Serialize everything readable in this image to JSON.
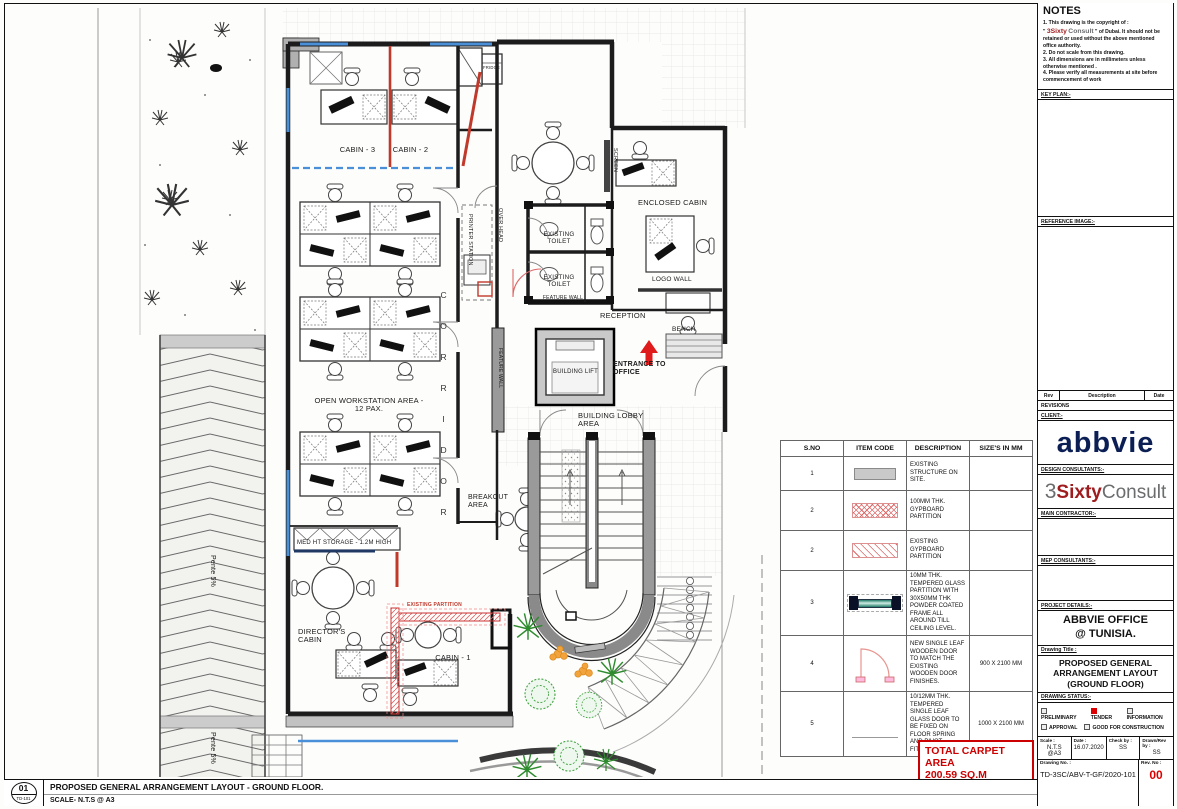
{
  "sheet": {
    "footer": {
      "number": "01",
      "code": "TD-101",
      "title": "PROPOSED GENERAL ARRANGEMENT LAYOUT - GROUND FLOOR.",
      "scale": "SCALE- N.T.S @ A3"
    },
    "carpet": {
      "line1": "TOTAL CARPET AREA",
      "line2": "200.59 SQ.M"
    }
  },
  "plan": {
    "labels": {
      "fridge": "FRIDGE",
      "cabin3": "CABIN - 3",
      "cabin2": "CABIN - 2",
      "cabin1": "CABIN - 1",
      "screen": "SCREEN",
      "over_head": "OVER HEAD",
      "printer_station": "PRINTER STATION",
      "toilet": "EXISTING TOILET",
      "feature_wall": "FEATURE WALL",
      "enclosed_cabin": "ENCLOSED CABIN",
      "logo_wall": "LOGO WALL",
      "reception": "RECEPTION",
      "bench": "BENCH",
      "building_lift": "BUILDING LIFT",
      "entrance": "ENTRANCE TO OFFICE",
      "lobby": "BUILDING LOBBY AREA",
      "corridor": "CORRIDOR",
      "open_ws": "OPEN WORKSTATION AREA - 12 PAX.",
      "breakout": "BREAKOUT AREA",
      "storage": "MED HT STORAGE - 1.2M HIGH",
      "directors": "DIRECTOR'S CABIN",
      "existing_partition": "EXISTING PARTITION",
      "pente": "Pente 5%"
    }
  },
  "legend": {
    "headers": [
      "S.NO",
      "ITEM CODE",
      "DESCRIPTION",
      "SIZE'S IN MM"
    ],
    "rows": [
      {
        "sno": "1",
        "symbol": "existing-structure-swatch",
        "desc": "EXISTING STRUCTURE ON SITE.",
        "size": ""
      },
      {
        "sno": "2",
        "symbol": "gypboard-crosshatch-swatch",
        "desc": "100MM THK. GYPBOARD PARTITION",
        "size": ""
      },
      {
        "sno": "2",
        "symbol": "existing-gypboard-hatch-swatch",
        "desc": "EXISTING GYPBOARD PARTITION",
        "size": ""
      },
      {
        "sno": "3",
        "symbol": "glass-partition-symbol",
        "desc": "10MM THK. TEMPERED GLASS PARTITION WITH 30X50MM THK POWDER COATED FRAME ALL AROUND TILL CEILING LEVEL.",
        "size": ""
      },
      {
        "sno": "4",
        "symbol": "wooden-door-symbol",
        "desc": "NEW SINGLE LEAF WOODEN DOOR TO MATCH THE EXISTING WOODEN DOOR FINISHES.",
        "size": "900 X 2100 MM"
      },
      {
        "sno": "5",
        "symbol": "glass-door-symbol",
        "desc": "10/12MM THK. TEMPERED SINGLE LEAF GLASS DOOR TO BE FIXED ON FLOOR SPRING AND PIVOT FITTING.",
        "size": "1000 X 2100 MM"
      }
    ]
  },
  "titleblock": {
    "notes": {
      "title": "NOTES",
      "n1_prefix": "1. This drawing is the copyright of :",
      "q1": "\"",
      "brand_red": "3Sixty",
      "brand_gray": "Consult",
      "q2": "\"",
      "n1_suffix": "of Dubai. It should not be retained or used without the above mentioned office authority.",
      "n2": "2. Do not scale from this drawing.",
      "n3": "3. All dimensions are in millimeters unless otherwise mentioned .",
      "n4": "4. Please verify all measurements at site before commencement of work"
    },
    "keyplan_label": "KEY PLAN:-",
    "refimage_label": "REFERENCE IMAGE:-",
    "revisions": {
      "rev": "Rev",
      "description": "Description",
      "date": "Date",
      "label": "REVISIONS"
    },
    "client": {
      "label": "CLIENT:-",
      "logo": "abbvie"
    },
    "design": {
      "label": "DESIGN CONSULTANTS:-",
      "logo_3": "3",
      "logo_sixty": "Sixty",
      "logo_consult": "Consult"
    },
    "contractor_label": "MAIN CONTRACTOR:-",
    "mep_label": "MEP CONSULTANTS:-",
    "project": {
      "label": "PROJECT DETAILS:-",
      "line1": "ABBVIE OFFICE",
      "line2": "@ TUNISIA."
    },
    "drawing_title": {
      "label": "Drawing Title :",
      "line1": "PROPOSED GENERAL",
      "line2": "ARRANGEMENT LAYOUT",
      "line3": "(GROUND FLOOR)"
    },
    "status": {
      "label": "DRAWING STATUS:-",
      "s1": "PRELIMINARY",
      "s2": "TENDER",
      "s3": "INFORMATION",
      "s4": "APPROVAL",
      "s5": "GOOD FOR CONSTRUCTION"
    },
    "fields": {
      "scale_label": "Scale :",
      "scale_value": "N.T.S @A3",
      "date_label": "Date :",
      "date_value": "16.07.2020",
      "check_label": "Check by :",
      "check_value": "SS",
      "drawn_label": "Drawn/Rev by :",
      "drawn_value": "SS"
    },
    "dno": {
      "label": "Drawing No. :",
      "value": "TD-3SC/ABV-T-GF/2020-101",
      "rev_label": "Rev. No :",
      "rev_value": "00"
    }
  }
}
